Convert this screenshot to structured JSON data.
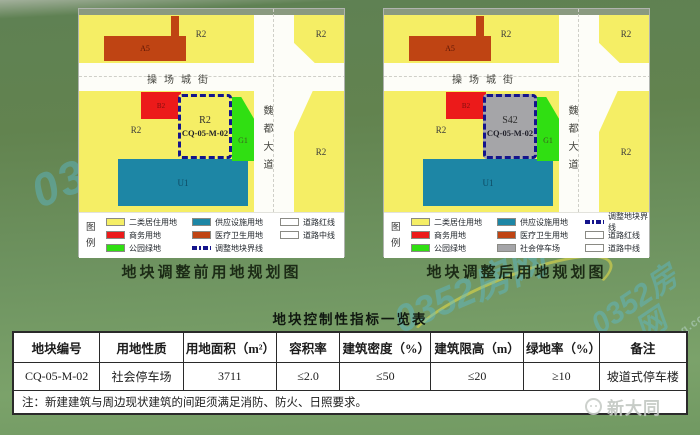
{
  "colors": {
    "yellow": "#f5ee65",
    "red": "#ec1a1a",
    "brick": "#bf4413",
    "green": "#30df12",
    "teal": "#1d86a5",
    "gray": "#a5a5a8",
    "road": "#fdfdf8",
    "plot_border": "#14148c",
    "caption": "#1c2b16",
    "watermark": "#5abcd6"
  },
  "watermark": {
    "brand": "0352房网",
    "url": "www.0352fang.com"
  },
  "maps": {
    "before": {
      "caption": "地块调整前用地规划图",
      "legend_title": "图例",
      "street": "操场城街",
      "avenue": "魏都大道",
      "labels": {
        "r2_topleft": "R2",
        "r2_topright": "R2",
        "r2_right": "R2",
        "r2_left": "R2",
        "a5": "A5",
        "b2": "B2",
        "g1": "G1",
        "u1": "U1",
        "plot_use": "R2",
        "plot_code": "CQ-05-M-02"
      },
      "legend": [
        {
          "label": "二类居住用地"
        },
        {
          "label": "商务用地"
        },
        {
          "label": "公园绿地"
        },
        {
          "label": "供应设施用地"
        },
        {
          "label": "医疗卫生用地"
        },
        {
          "label": "调整地块界线"
        },
        {
          "label": "道路红线"
        },
        {
          "label": "道路中线"
        }
      ]
    },
    "after": {
      "caption": "地块调整后用地规划图",
      "legend_title": "图例",
      "street": "操场城街",
      "avenue": "魏都大道",
      "labels": {
        "r2_topleft": "R2",
        "r2_topright": "R2",
        "r2_right": "R2",
        "r2_left": "R2",
        "a5": "A5",
        "b2": "B2",
        "g1": "G1",
        "u1": "U1",
        "plot_use": "S42",
        "plot_code": "CQ-05-M-02"
      },
      "legend": [
        {
          "label": "二类居住用地"
        },
        {
          "label": "商务用地"
        },
        {
          "label": "公园绿地"
        },
        {
          "label": "供应设施用地"
        },
        {
          "label": "医疗卫生用地"
        },
        {
          "label": "社会停车场"
        },
        {
          "label": "调整地块界线"
        },
        {
          "label": "道路红线"
        },
        {
          "label": "道路中线"
        }
      ]
    }
  },
  "table": {
    "title": "地块控制性指标一览表",
    "headers": [
      "地块编号",
      "用地性质",
      "用地面积（m²）",
      "容积率",
      "建筑密度（%）",
      "建筑限高（m）",
      "绿地率（%）",
      "备注"
    ],
    "row": [
      "CQ-05-M-02",
      "社会停车场",
      "3711",
      "≤2.0",
      "≤50",
      "≤20",
      "≥10",
      "坡道式停车楼"
    ],
    "note": "注：新建建筑与周边现状建筑的间距须满足消防、防火、日照要求。"
  },
  "logo": {
    "text": "新大同"
  }
}
